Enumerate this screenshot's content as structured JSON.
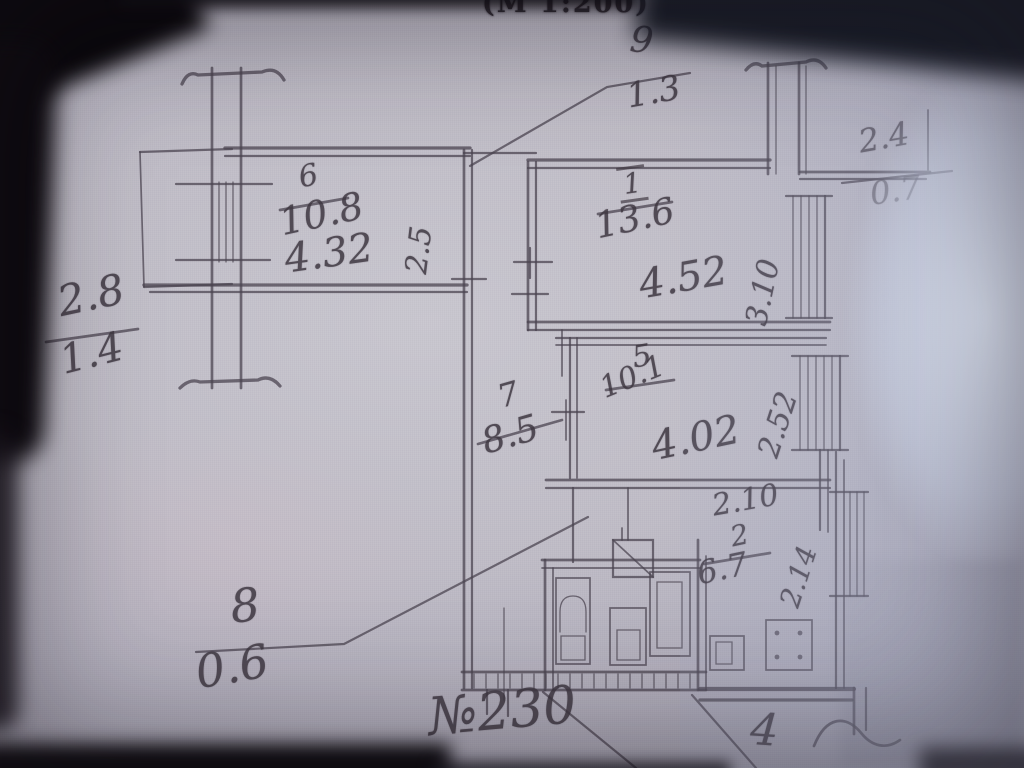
{
  "photo": {
    "scale_note": "(М 1:200)",
    "plan_no": "№230",
    "corner_mark": "4",
    "ink_color": "#3e3741",
    "paper_color": "#bfbcc6",
    "glare_color": "#dde6f5"
  },
  "rooms": {
    "r9": {
      "number": "9",
      "area": "1.3"
    },
    "r6": {
      "number": "6",
      "area": "10.8",
      "width": "4.32",
      "depth": "2.5"
    },
    "r1": {
      "number": "1",
      "area": "13.6",
      "width": "4.52",
      "depth": "3.10"
    },
    "r5": {
      "number": "5",
      "area": "10.1",
      "width": "4.02",
      "depth": "2.52"
    },
    "r7": {
      "number": "7",
      "area": "8.5"
    },
    "r2": {
      "number": "2",
      "area": "6.7",
      "width": "2.10",
      "depth": "2.14"
    },
    "r8": {
      "number": "8",
      "area": "0.6"
    },
    "balcony_left": {
      "number": "2.8",
      "area": "1.4"
    },
    "balcony_right": {
      "number": "2.4",
      "area": "0.7"
    }
  }
}
